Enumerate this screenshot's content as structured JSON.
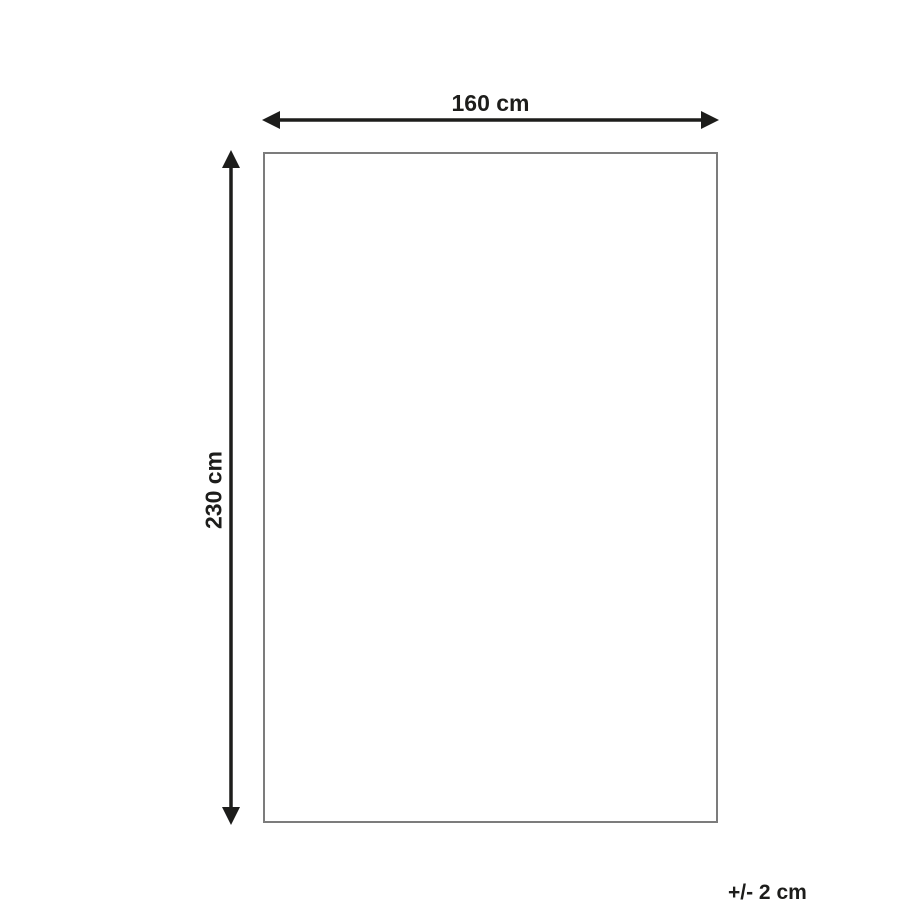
{
  "diagram": {
    "background_color": "#ffffff",
    "rectangle": {
      "border_color": "#7c7c7c"
    },
    "arrow_color": "#1d1d1b",
    "dimensions": {
      "width": {
        "label": "160 cm"
      },
      "height": {
        "label": "230 cm"
      },
      "tolerance": {
        "label": "+/- 2 cm"
      }
    },
    "icons": {
      "horizontal_arrow": "double-headed-arrow-horizontal",
      "vertical_arrow": "double-headed-arrow-vertical"
    }
  }
}
